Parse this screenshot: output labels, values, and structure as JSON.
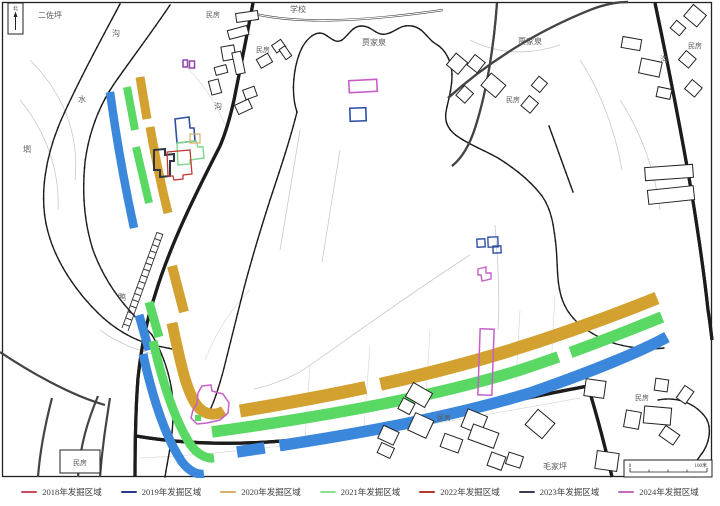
{
  "colors": {
    "band_gold": "#D2A12F",
    "band_green": "#59D964",
    "band_blue": "#3B87DC",
    "outline_navy": "#2E4FA3",
    "outline_red": "#C23B34",
    "outline_dark": "#2F3542",
    "outline_magenta": "#C75FC7",
    "outline_purple": "#8E44AD",
    "outline_tan": "#D9B06A",
    "outline_lightgreen": "#7FD98A"
  },
  "map": {
    "north_label": "北",
    "scale": {
      "left": "0",
      "right": "100米"
    },
    "labels": [
      {
        "text": "二佐坪"
      },
      {
        "text": "民房"
      },
      {
        "text": "学校"
      },
      {
        "text": "贾家泉"
      },
      {
        "text": "贾家泉"
      },
      {
        "text": "民房"
      },
      {
        "text": "民房"
      },
      {
        "text": "沟"
      },
      {
        "text": "水"
      },
      {
        "text": "沟"
      },
      {
        "text": "沟"
      },
      {
        "text": "垇"
      },
      {
        "text": "民房"
      },
      {
        "text": "鸭"
      },
      {
        "text": "民房"
      },
      {
        "text": "民房"
      },
      {
        "text": "毛家坪"
      },
      {
        "text": "民房"
      }
    ]
  },
  "legend": {
    "items": [
      {
        "label": "2018年发掘区域",
        "color": "#C84A5F"
      },
      {
        "label": "2019年发掘区域",
        "color": "#2B3A8C"
      },
      {
        "label": "2020年发掘区域",
        "color": "#D9B06A"
      },
      {
        "label": "2021年发掘区域",
        "color": "#8CDE96"
      },
      {
        "label": "2022年发掘区域",
        "color": "#B03A2E"
      },
      {
        "label": "2023年发掘区域",
        "color": "#3C4150"
      },
      {
        "label": "2024年发掘区域",
        "color": "#C06BC0"
      }
    ]
  }
}
